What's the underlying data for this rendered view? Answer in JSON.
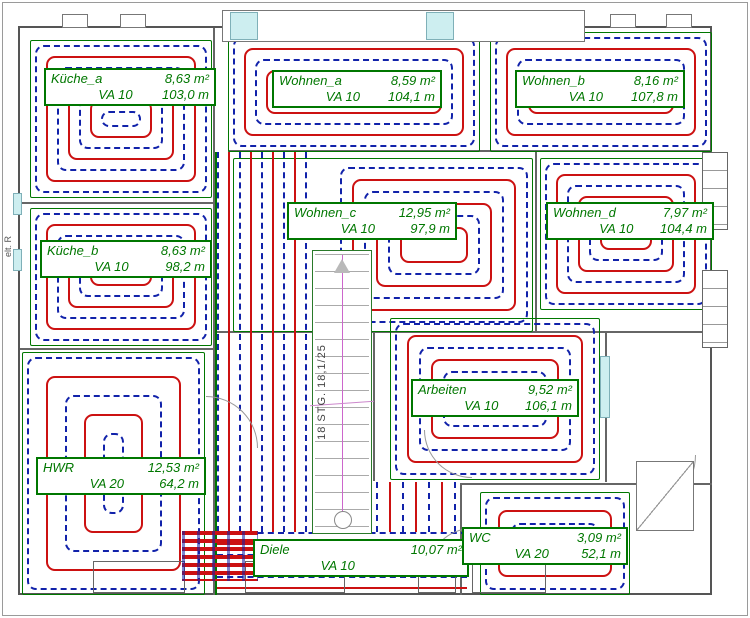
{
  "drawing": {
    "title": "Fussbodenheizung Verlegeplan",
    "stair_label": "18 STG. 18,1/25",
    "side_label": "elt. R"
  },
  "rooms": [
    {
      "id": "kueche_a",
      "name": "Küche_a",
      "area": "8,63 m²",
      "va": "VA 10",
      "length": "103,0 m"
    },
    {
      "id": "wohnen_a",
      "name": "Wohnen_a",
      "area": "8,59 m²",
      "va": "VA 10",
      "length": "104,1 m"
    },
    {
      "id": "wohnen_b",
      "name": "Wohnen_b",
      "area": "8,16 m²",
      "va": "VA 10",
      "length": "107,8 m"
    },
    {
      "id": "wohnen_c",
      "name": "Wohnen_c",
      "area": "12,95 m²",
      "va": "VA 10",
      "length": "97,9 m"
    },
    {
      "id": "wohnen_d",
      "name": "Wohnen_d",
      "area": "7,97 m²",
      "va": "VA 10",
      "length": "104,4 m"
    },
    {
      "id": "kueche_b",
      "name": "Küche_b",
      "area": "8,63 m²",
      "va": "VA 10",
      "length": "98,2 m"
    },
    {
      "id": "hwr",
      "name": "HWR",
      "area": "12,53 m²",
      "va": "VA 20",
      "length": "64,2 m"
    },
    {
      "id": "arbeiten",
      "name": "Arbeiten",
      "area": "9,52 m²",
      "va": "VA 10",
      "length": "106,1 m"
    },
    {
      "id": "diele",
      "name": "Diele",
      "area": "10,07 m²",
      "va": "VA 10",
      "length": ""
    },
    {
      "id": "wc",
      "name": "WC",
      "area": "3,09 m²",
      "va": "VA 20",
      "length": "52,1 m"
    }
  ],
  "colors": {
    "pipe_supply": "#cc1111",
    "pipe_return": "#1122aa",
    "zone_border": "#007700",
    "label_text": "#007700",
    "wall": "#555555",
    "window": "#cdeef0",
    "stair_centerline": "#cc66cc"
  }
}
